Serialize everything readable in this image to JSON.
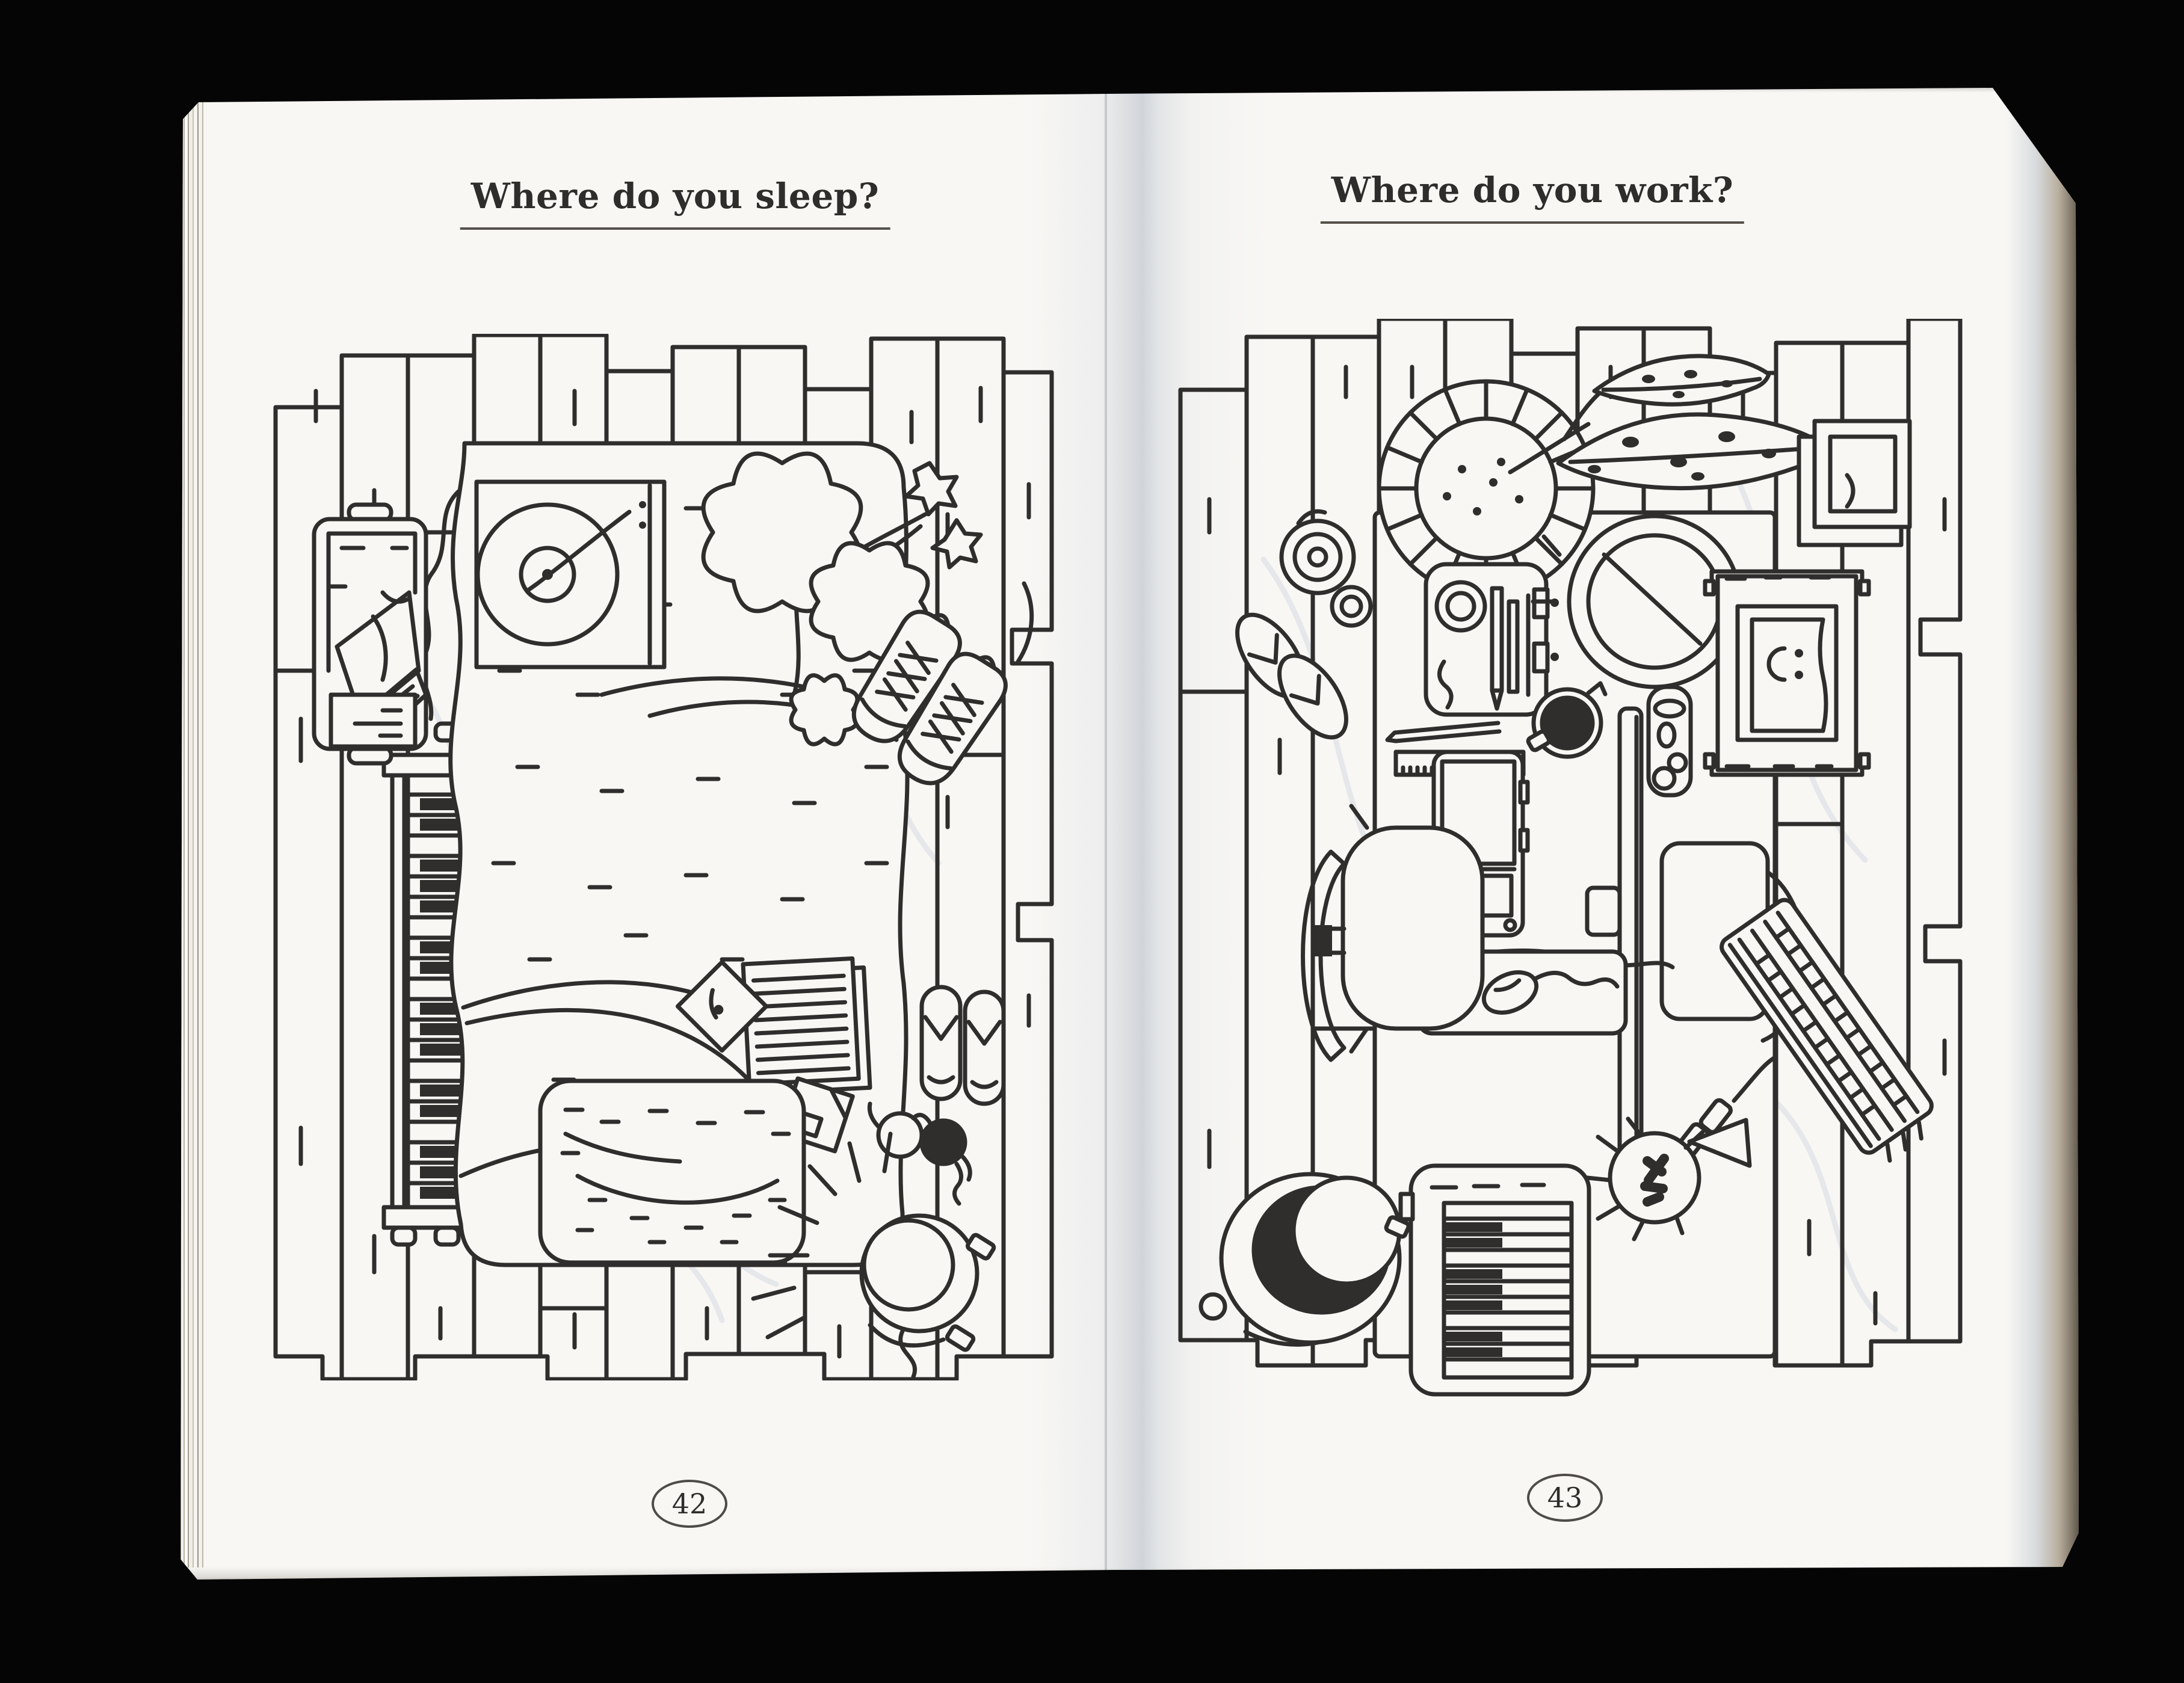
{
  "photo": {
    "background_color": "#050505",
    "paper_color": "#f8f7f4",
    "ink_color": "#2f2e2c"
  },
  "left_page": {
    "title": "Where do you sleep?",
    "page_number": "42",
    "objects": [
      "wood plank floor",
      "bed with blanket",
      "record player",
      "plant sprig",
      "sneakers",
      "piano keyboard",
      "laundry basket",
      "notebook",
      "photograph",
      "floppy disk",
      "rug",
      "slippers",
      "eyeglasses",
      "bedside lamp"
    ]
  },
  "right_page": {
    "title": "Where do you work?",
    "page_number": "43",
    "objects": [
      "wood plank floor",
      "desk",
      "potted plant",
      "leaves",
      "pencil cup",
      "round mirror",
      "printer with smiley page",
      "paper trays",
      "laptop",
      "monitor top view",
      "monitor stand",
      "coffee cup",
      "ruler",
      "pencil",
      "mouse pad",
      "mouse",
      "desk lamp",
      "midi keyboard",
      "computer keyboard",
      "office chair",
      "bucket",
      "flip-flops",
      "tape rolls",
      "usb hub"
    ]
  }
}
